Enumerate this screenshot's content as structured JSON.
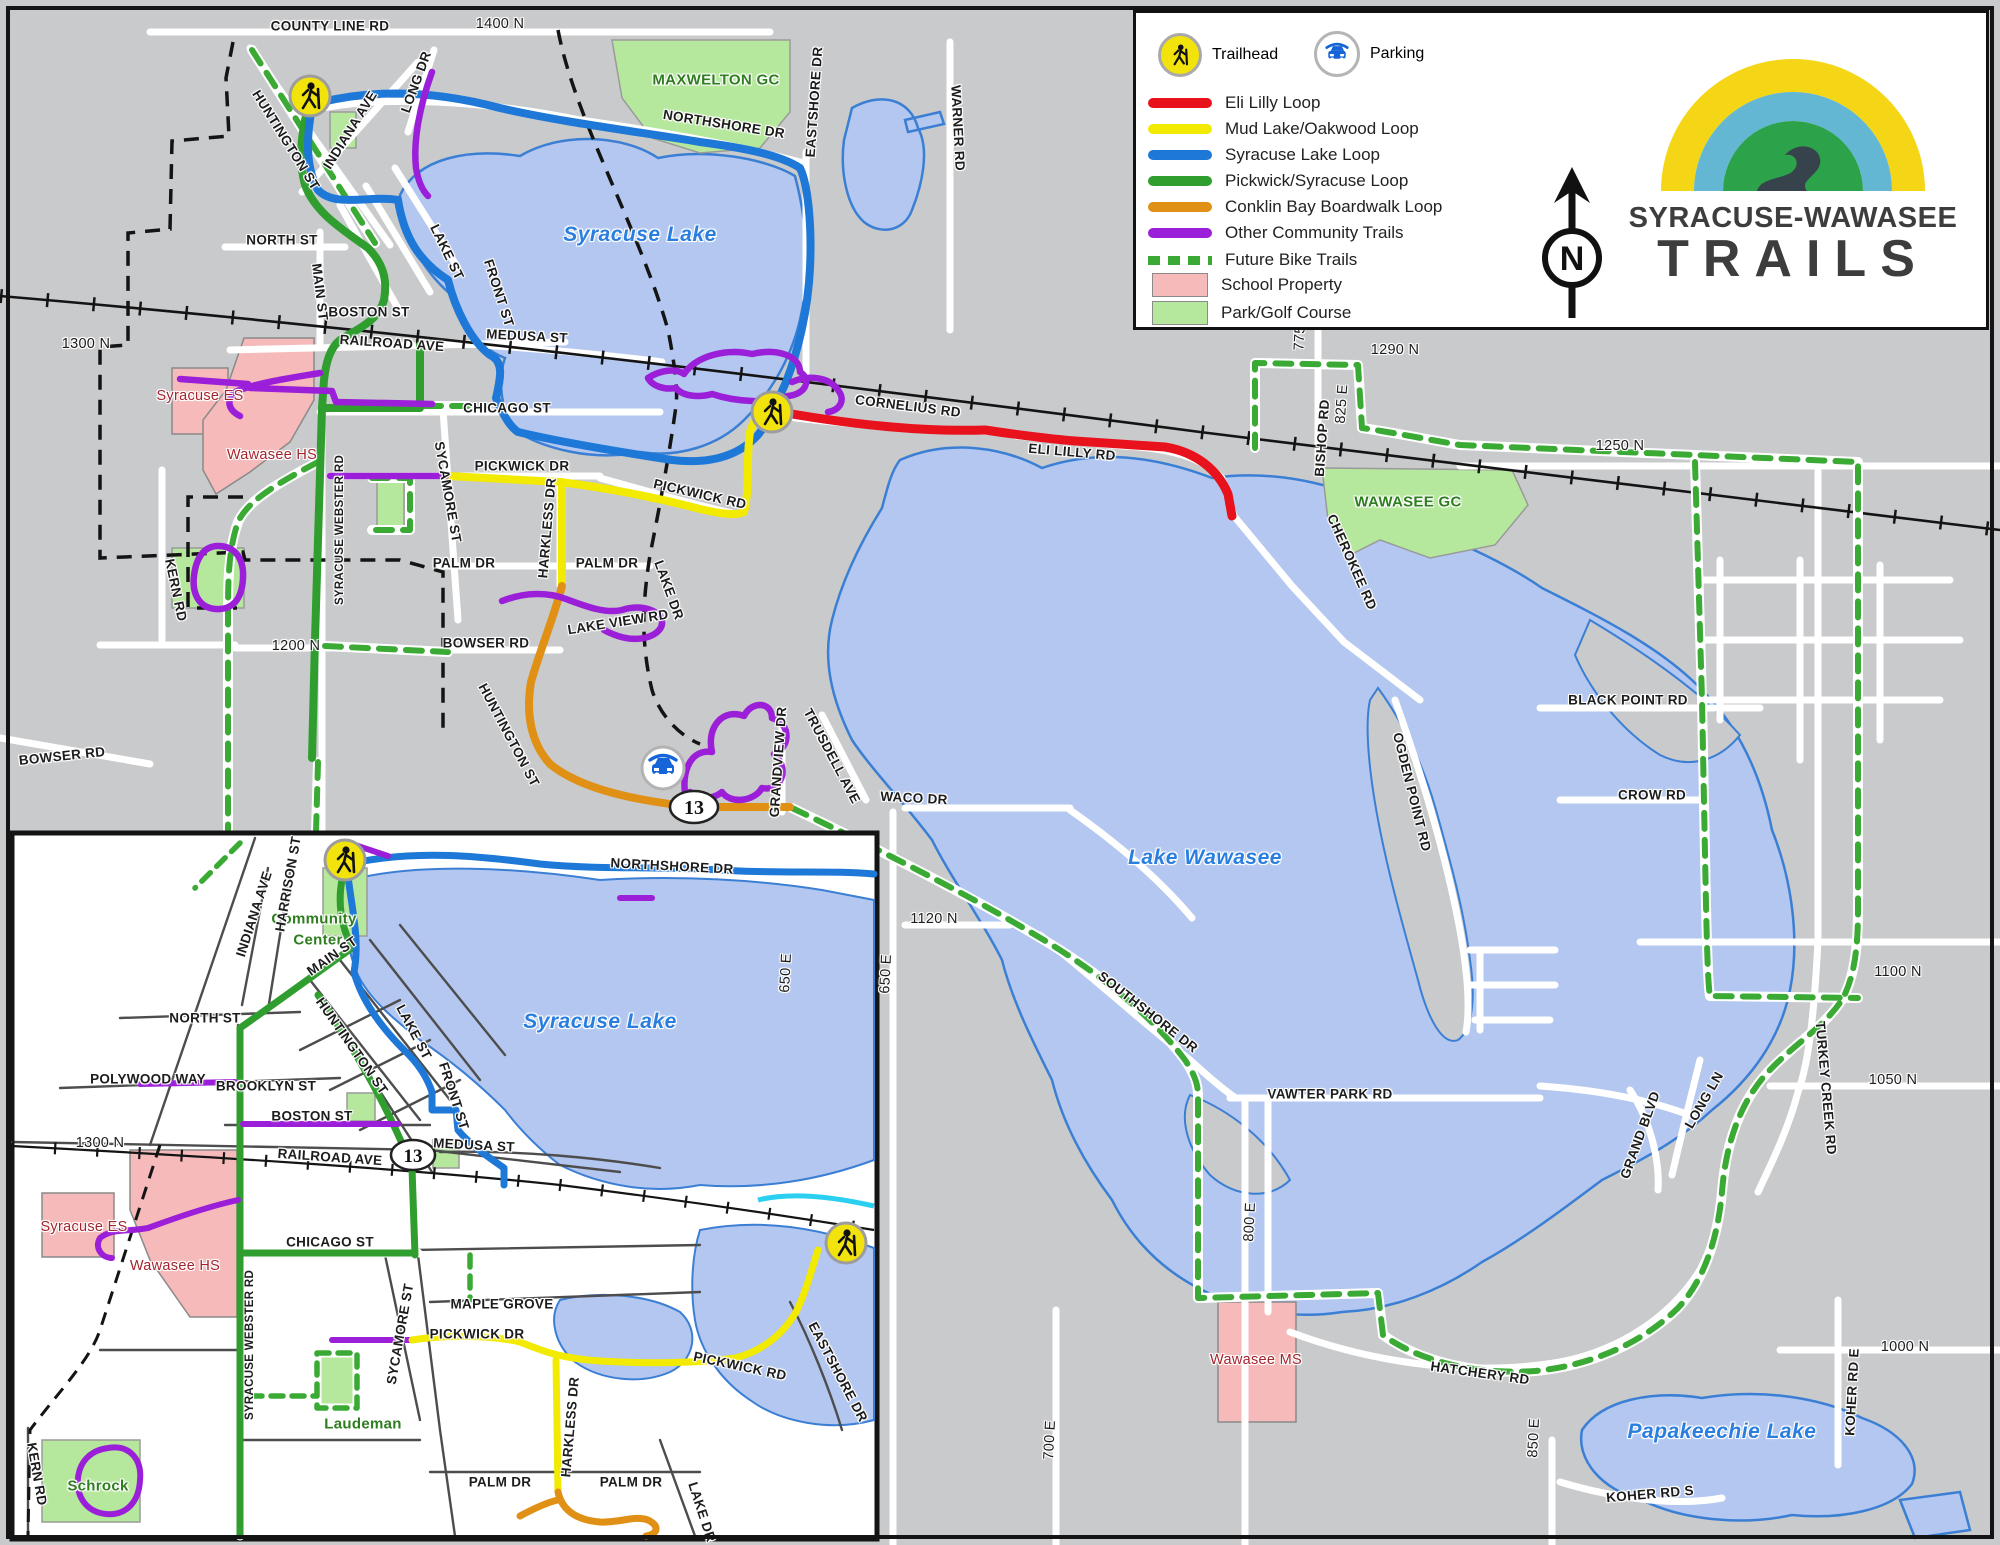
{
  "logo": {
    "line1": "SYRACUSE-WAWASEE",
    "line2": "TRAILS"
  },
  "compass": {
    "letter": "N"
  },
  "badges": {
    "route": "13"
  },
  "legend": {
    "trailhead_label": "Trailhead",
    "parking_label": "Parking",
    "lines": [
      {
        "label": "Eli Lilly Loop",
        "color": "#e8121c"
      },
      {
        "label": "Mud Lake/Oakwood Loop",
        "color": "#f2ea00"
      },
      {
        "label": "Syracuse Lake Loop",
        "color": "#1e78d7"
      },
      {
        "label": "Pickwick/Syracuse Loop",
        "color": "#2f9e2f"
      },
      {
        "label": "Conklin Bay Boardwalk Loop",
        "color": "#e09015"
      },
      {
        "label": "Other Community Trails",
        "color": "#9b1fd8"
      },
      {
        "label": "Future Bike Trails",
        "color": "#3aaa35",
        "style": "dashed"
      }
    ],
    "areas": [
      {
        "label": "School Property",
        "color": "#f6baba"
      },
      {
        "label": "Park/Golf Course",
        "color": "#b5e89c"
      }
    ]
  },
  "colors": {
    "water": "#b3c7f0",
    "land": "#c9cacc",
    "road": "#ffffff",
    "railroad": "#111111",
    "future_trail": "#3aaa35",
    "school_fill": "#f6baba",
    "park_fill": "#b5e89c",
    "stream": "#2bd0f0"
  },
  "map_labels": [
    {
      "id": "county-line-rd",
      "t": "COUNTY LINE RD",
      "x": 330,
      "y": 26
    },
    {
      "id": "n1400",
      "t": "1400 N",
      "x": 500,
      "y": 24,
      "c": "coord"
    },
    {
      "id": "huntington-nw",
      "t": "HUNTINGTON ST",
      "x": 286,
      "y": 140,
      "r": 58
    },
    {
      "id": "indiana-ave",
      "t": "INDIANA AVE",
      "x": 350,
      "y": 130,
      "r": -58
    },
    {
      "id": "long-dr",
      "t": "LONG DR",
      "x": 416,
      "y": 82,
      "r": -70
    },
    {
      "id": "maxwelton-gc",
      "t": "MAXWELTON GC",
      "x": 716,
      "y": 80,
      "c": "golf"
    },
    {
      "id": "northshore-dr",
      "t": "NORTHSHORE DR",
      "x": 724,
      "y": 124,
      "r": 9
    },
    {
      "id": "eastshore-dr",
      "t": "EASTSHORE DR",
      "x": 814,
      "y": 102,
      "r": -86
    },
    {
      "id": "warner-rd",
      "t": "WARNER RD",
      "x": 958,
      "y": 128,
      "r": 87
    },
    {
      "id": "syracuse-lake",
      "t": "Syracuse Lake",
      "x": 640,
      "y": 235,
      "c": "lake"
    },
    {
      "id": "north-st",
      "t": "NORTH ST",
      "x": 282,
      "y": 240
    },
    {
      "id": "main-st",
      "t": "MAIN ST",
      "x": 320,
      "y": 292,
      "r": 83
    },
    {
      "id": "lake-st",
      "t": "LAKE ST",
      "x": 447,
      "y": 252,
      "r": 64
    },
    {
      "id": "front-st",
      "t": "FRONT ST",
      "x": 499,
      "y": 293,
      "r": 72
    },
    {
      "id": "boston-st",
      "t": "BOSTON ST",
      "x": 369,
      "y": 312
    },
    {
      "id": "railroad-ave",
      "t": "RAILROAD AVE",
      "x": 392,
      "y": 343,
      "r": 4
    },
    {
      "id": "n1300",
      "t": "1300 N",
      "x": 86,
      "y": 344,
      "c": "coord"
    },
    {
      "id": "medusa-st",
      "t": "MEDUSA ST",
      "x": 527,
      "y": 336,
      "r": 3
    },
    {
      "id": "syracuse-es",
      "t": "Syracuse ES",
      "x": 200,
      "y": 396,
      "c": "school"
    },
    {
      "id": "wawasee-hs",
      "t": "Wawasee HS",
      "x": 272,
      "y": 455,
      "c": "school"
    },
    {
      "id": "chicago-st",
      "t": "CHICAGO ST",
      "x": 507,
      "y": 408
    },
    {
      "id": "syr-webster-rd",
      "t": "SYRACUSE WEBSTER RD",
      "x": 340,
      "y": 530,
      "r": -90,
      "c": "small"
    },
    {
      "id": "sycamore-st",
      "t": "SYCAMORE ST",
      "x": 448,
      "y": 492,
      "r": 80
    },
    {
      "id": "pickwick-dr",
      "t": "PICKWICK DR",
      "x": 522,
      "y": 466
    },
    {
      "id": "pickwick-rd",
      "t": "PICKWICK RD",
      "x": 700,
      "y": 494,
      "r": 13
    },
    {
      "id": "cornelius-rd",
      "t": "CORNELIUS RD",
      "x": 908,
      "y": 406,
      "r": 7
    },
    {
      "id": "eli-lilly-rd",
      "t": "ELI LILLY RD",
      "x": 1072,
      "y": 452,
      "r": 5
    },
    {
      "id": "n775",
      "t": "775",
      "x": 1300,
      "y": 338,
      "r": -87,
      "c": "coord"
    },
    {
      "id": "n1290",
      "t": "1290 N",
      "x": 1395,
      "y": 350,
      "c": "coord"
    },
    {
      "id": "bishop-rd",
      "t": "BISHOP RD",
      "x": 1322,
      "y": 438,
      "r": -86
    },
    {
      "id": "e825",
      "t": "825 E",
      "x": 1342,
      "y": 404,
      "r": -86,
      "c": "coord"
    },
    {
      "id": "n1250",
      "t": "1250 N",
      "x": 1620,
      "y": 446,
      "c": "coord"
    },
    {
      "id": "wawasee-gc",
      "t": "WAWASEE GC",
      "x": 1408,
      "y": 502,
      "c": "golf"
    },
    {
      "id": "cherokee-rd",
      "t": "CHEROKEE RD",
      "x": 1352,
      "y": 562,
      "r": 66
    },
    {
      "id": "palm-dr-a",
      "t": "PALM DR",
      "x": 464,
      "y": 563
    },
    {
      "id": "palm-dr-b",
      "t": "PALM DR",
      "x": 607,
      "y": 563
    },
    {
      "id": "harkless-dr",
      "t": "HARKLESS DR",
      "x": 547,
      "y": 528,
      "r": -85
    },
    {
      "id": "kern-rd",
      "t": "KERN RD",
      "x": 176,
      "y": 590,
      "r": 78
    },
    {
      "id": "n1200",
      "t": "1200 N",
      "x": 296,
      "y": 646,
      "c": "coord"
    },
    {
      "id": "bowser-rd",
      "t": "BOWSER RD",
      "x": 486,
      "y": 643
    },
    {
      "id": "bowser-rd-w",
      "t": "BOWSER RD",
      "x": 62,
      "y": 756,
      "r": -6
    },
    {
      "id": "lake-view-rd",
      "t": "LAKE VIEW RD",
      "x": 618,
      "y": 622,
      "r": -9
    },
    {
      "id": "lake-dr",
      "t": "LAKE DR",
      "x": 669,
      "y": 590,
      "r": 70
    },
    {
      "id": "huntington-s",
      "t": "HUNTINGTON ST",
      "x": 509,
      "y": 735,
      "r": 62
    },
    {
      "id": "grandview-dr",
      "t": "GRANDVIEW DR",
      "x": 778,
      "y": 762,
      "r": -86
    },
    {
      "id": "trusdell-ave",
      "t": "TRUSDELL AVE",
      "x": 832,
      "y": 756,
      "r": 62
    },
    {
      "id": "waco-dr",
      "t": "WACO DR",
      "x": 914,
      "y": 798,
      "r": 3
    },
    {
      "id": "e650",
      "t": "650 E",
      "x": 886,
      "y": 974,
      "r": -87,
      "c": "coord"
    },
    {
      "id": "n1120",
      "t": "1120 N",
      "x": 934,
      "y": 919,
      "c": "coord"
    },
    {
      "id": "lake-wawasee",
      "t": "Lake Wawasee",
      "x": 1205,
      "y": 858,
      "c": "lake"
    },
    {
      "id": "southshore-dr",
      "t": "SOUTHSHORE DR",
      "x": 1148,
      "y": 1012,
      "r": 38
    },
    {
      "id": "ogden-point-rd",
      "t": "OGDEN POINT RD",
      "x": 1412,
      "y": 792,
      "r": 76
    },
    {
      "id": "black-point-rd",
      "t": "BLACK POINT RD",
      "x": 1628,
      "y": 700
    },
    {
      "id": "crow-rd",
      "t": "CROW RD",
      "x": 1652,
      "y": 795
    },
    {
      "id": "n1100",
      "t": "1100 N",
      "x": 1898,
      "y": 972,
      "c": "coord"
    },
    {
      "id": "vawter-park-rd",
      "t": "VAWTER PARK RD",
      "x": 1330,
      "y": 1094
    },
    {
      "id": "e800",
      "t": "800 E",
      "x": 1250,
      "y": 1222,
      "r": -87,
      "c": "coord"
    },
    {
      "id": "e700",
      "t": "700 E",
      "x": 1050,
      "y": 1440,
      "r": -87,
      "c": "coord"
    },
    {
      "id": "wawasee-ms",
      "t": "Wawasee MS",
      "x": 1256,
      "y": 1360,
      "c": "school"
    },
    {
      "id": "hatchery-rd",
      "t": "HATCHERY RD",
      "x": 1480,
      "y": 1373,
      "r": 8
    },
    {
      "id": "koher-rd-e",
      "t": "KOHER RD E",
      "x": 1852,
      "y": 1392,
      "r": -87
    },
    {
      "id": "n1000",
      "t": "1000 N",
      "x": 1905,
      "y": 1347,
      "c": "coord"
    },
    {
      "id": "e850",
      "t": "850 E",
      "x": 1534,
      "y": 1438,
      "r": -87,
      "c": "coord"
    },
    {
      "id": "papakeechie-lake",
      "t": "Papakeechie Lake",
      "x": 1722,
      "y": 1432,
      "c": "lake"
    },
    {
      "id": "koher-rd-s",
      "t": "KOHER RD S",
      "x": 1650,
      "y": 1494,
      "r": -5
    },
    {
      "id": "grand-blvd",
      "t": "GRAND BLVD",
      "x": 1640,
      "y": 1135,
      "r": -70
    },
    {
      "id": "long-ln",
      "t": "LONG LN",
      "x": 1704,
      "y": 1100,
      "r": -60
    },
    {
      "id": "turkey-creek-rd",
      "t": "TURKEY CREEK RD",
      "x": 1826,
      "y": 1088,
      "r": 85
    },
    {
      "id": "n1050",
      "t": "1050 N",
      "x": 1893,
      "y": 1080,
      "c": "coord"
    },
    {
      "id": "i-northshore",
      "t": "NORTHSHORE DR",
      "x": 672,
      "y": 866,
      "r": 3
    },
    {
      "id": "i-community",
      "t": "Community",
      "x": 314,
      "y": 919,
      "c": "golf"
    },
    {
      "id": "i-center",
      "t": "Center",
      "x": 318,
      "y": 940,
      "c": "golf"
    },
    {
      "id": "i-harrison",
      "t": "HARRISON ST",
      "x": 288,
      "y": 884,
      "r": -80
    },
    {
      "id": "i-indiana",
      "t": "INDIANA AVE",
      "x": 254,
      "y": 914,
      "r": -72
    },
    {
      "id": "i-main",
      "t": "MAIN ST",
      "x": 332,
      "y": 956,
      "r": -35
    },
    {
      "id": "i-north",
      "t": "NORTH ST",
      "x": 205,
      "y": 1018
    },
    {
      "id": "i-huntington",
      "t": "HUNTINGTON ST",
      "x": 352,
      "y": 1046,
      "r": 55
    },
    {
      "id": "i-lake-st",
      "t": "LAKE ST",
      "x": 414,
      "y": 1032,
      "r": 62
    },
    {
      "id": "i-front",
      "t": "FRONT ST",
      "x": 454,
      "y": 1096,
      "r": 72
    },
    {
      "id": "i-syracuse-lake",
      "t": "Syracuse Lake",
      "x": 600,
      "y": 1022,
      "c": "lake"
    },
    {
      "id": "i-polywood",
      "t": "POLYWOOD WAY",
      "x": 148,
      "y": 1079
    },
    {
      "id": "i-brooklyn",
      "t": "BROOKLYN ST",
      "x": 266,
      "y": 1086
    },
    {
      "id": "i-boston",
      "t": "BOSTON ST",
      "x": 312,
      "y": 1116
    },
    {
      "id": "i-1300",
      "t": "1300 N",
      "x": 100,
      "y": 1143,
      "c": "coord"
    },
    {
      "id": "i-railroad",
      "t": "RAILROAD AVE",
      "x": 330,
      "y": 1157,
      "r": 4
    },
    {
      "id": "i-medusa",
      "t": "MEDUSA ST",
      "x": 474,
      "y": 1145,
      "r": 3
    },
    {
      "id": "i-650",
      "t": "650 E",
      "x": 786,
      "y": 973,
      "r": -87,
      "c": "coord"
    },
    {
      "id": "i-syracuse-es",
      "t": "Syracuse ES",
      "x": 84,
      "y": 1227,
      "c": "school"
    },
    {
      "id": "i-wawasee-hs",
      "t": "Wawasee HS",
      "x": 175,
      "y": 1266,
      "c": "school"
    },
    {
      "id": "i-chicago",
      "t": "CHICAGO ST",
      "x": 330,
      "y": 1242
    },
    {
      "id": "i-webster",
      "t": "SYRACUSE WEBSTER RD",
      "x": 250,
      "y": 1345,
      "r": -90,
      "c": "small"
    },
    {
      "id": "i-sycamore",
      "t": "SYCAMORE ST",
      "x": 400,
      "y": 1334,
      "r": -80
    },
    {
      "id": "i-maple",
      "t": "MAPLE GROVE",
      "x": 502,
      "y": 1304
    },
    {
      "id": "i-pickwick-dr",
      "t": "PICKWICK DR",
      "x": 477,
      "y": 1334
    },
    {
      "id": "i-pickwick-rd",
      "t": "PICKWICK RD",
      "x": 740,
      "y": 1366,
      "r": 12
    },
    {
      "id": "i-eastshore",
      "t": "EASTSHORE DR",
      "x": 838,
      "y": 1372,
      "r": 62
    },
    {
      "id": "i-harkless",
      "t": "HARKLESS DR",
      "x": 570,
      "y": 1427,
      "r": -85
    },
    {
      "id": "i-palm-a",
      "t": "PALM DR",
      "x": 500,
      "y": 1482
    },
    {
      "id": "i-palm-b",
      "t": "PALM DR",
      "x": 631,
      "y": 1482
    },
    {
      "id": "i-lake-dr",
      "t": "LAKE DR",
      "x": 702,
      "y": 1512,
      "r": 72
    },
    {
      "id": "i-laudeman",
      "t": "Laudeman",
      "x": 363,
      "y": 1424,
      "c": "golf"
    },
    {
      "id": "i-schrock",
      "t": "Schrock",
      "x": 98,
      "y": 1486,
      "c": "golf"
    },
    {
      "id": "i-kern",
      "t": "KERN RD",
      "x": 37,
      "y": 1474,
      "r": 80
    }
  ]
}
